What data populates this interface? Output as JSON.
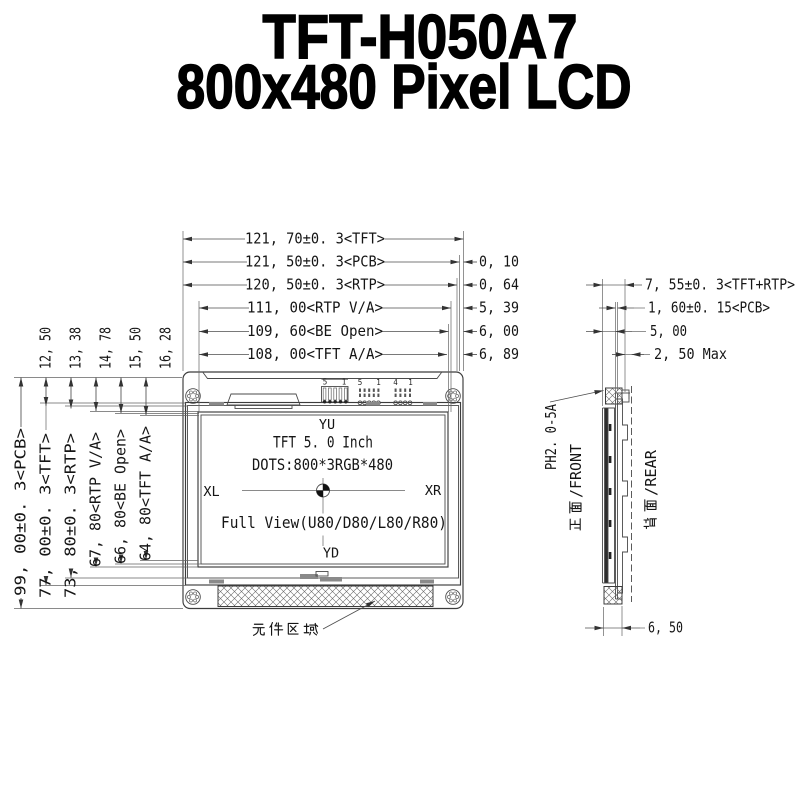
{
  "title": {
    "line1": "TFT-H050A7",
    "line2": "800x480 Pixel LCD"
  },
  "front_view": {
    "top_dims": [
      {
        "label": "121, 70±0. 3<TFT>"
      },
      {
        "label": "121, 50±0. 3<PCB>",
        "offset": "0, 10"
      },
      {
        "label": "120, 50±0. 3<RTP>",
        "offset": "0, 64"
      },
      {
        "label": "111, 00<RTP V/A>",
        "offset": "5, 39"
      },
      {
        "label": "109, 60<BE Open>",
        "offset": "6, 00"
      },
      {
        "label": "108, 00<TFT A/A>",
        "offset": "6, 89"
      }
    ],
    "left_dims_small": [
      "12, 50",
      "13, 38",
      "14, 78",
      "15, 50",
      "16, 28"
    ],
    "left_dims_large": [
      "99, 00±0. 3<PCB>",
      "77, 00±0. 3<TFT>",
      "73, 80±0. 3<RTP>",
      "67, 80<RTP V/A>",
      "66, 80<BE Open>",
      "64, 80<TFT A/A>"
    ],
    "screen": {
      "top_marker": "YU",
      "bottom_marker": "YD",
      "left_marker": "XL",
      "right_marker": "XR",
      "line1": "TFT 5. 0 Inch",
      "line2": "DOTS:800*3RGB*480",
      "line3": "Full View(U80/D80/L80/R80)"
    },
    "pin_header": {
      "first": "5",
      "last": "1"
    },
    "pad_group1": {
      "first": "5",
      "last": "1"
    },
    "pad_group2": {
      "first": "4",
      "last": "1"
    },
    "component_area_label": "元件区域"
  },
  "side_view": {
    "dims": [
      "7, 55±0. 3<TFT+RTP>",
      "1, 60±0. 15<PCB>",
      "5, 00",
      "2, 50 Max"
    ],
    "bottom_dim": "6, 50",
    "connector_label": "PH2. 0-5A",
    "front_label": {
      "cjk": "正面",
      "latin": "/FRONT"
    },
    "rear_label": {
      "cjk": "背面",
      "latin": "/REAR"
    }
  }
}
